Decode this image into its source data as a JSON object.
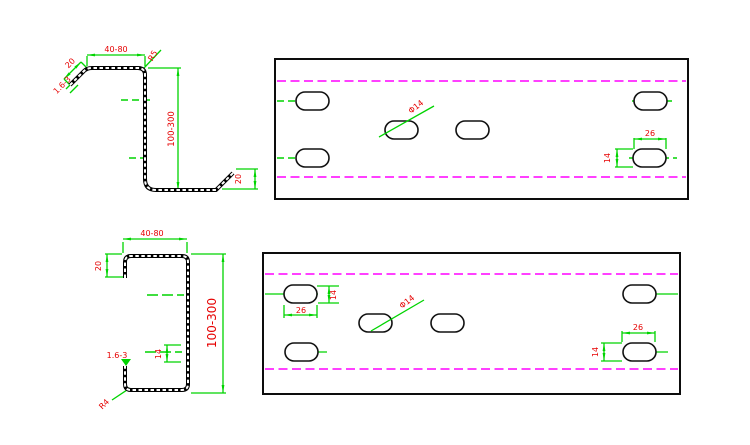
{
  "drawing": {
    "type": "sheet-metal profile drawing",
    "colors": {
      "background": "#ffffff",
      "profile_outline": "#000000",
      "dimension_lines": "#00d400",
      "dimension_text": "#e60000",
      "fold_lines": "#ff00ff"
    },
    "views": {
      "z_profile": {
        "labels": {
          "flange_width": "40-80",
          "bend_radius": "R5",
          "top_lip_length": "20",
          "thickness": "1.6-3",
          "web_height": "100-300",
          "bottom_lip_length": "20"
        }
      },
      "top_strip": {
        "labels": {
          "hole_diameter": "Φ14",
          "slot_length": "26",
          "slot_width": "14"
        }
      },
      "c_profile": {
        "labels": {
          "flange_width": "40-80",
          "lip_length": "20",
          "web_height": "100-300",
          "slot_width": "14",
          "thickness": "1.6-3",
          "bend_radius": "R4"
        }
      },
      "bottom_strip": {
        "labels": {
          "slot_width_left": "14",
          "slot_length_left": "26",
          "hole_diameter": "Φ14",
          "slot_length_right": "26",
          "slot_width_right": "14"
        }
      }
    }
  }
}
